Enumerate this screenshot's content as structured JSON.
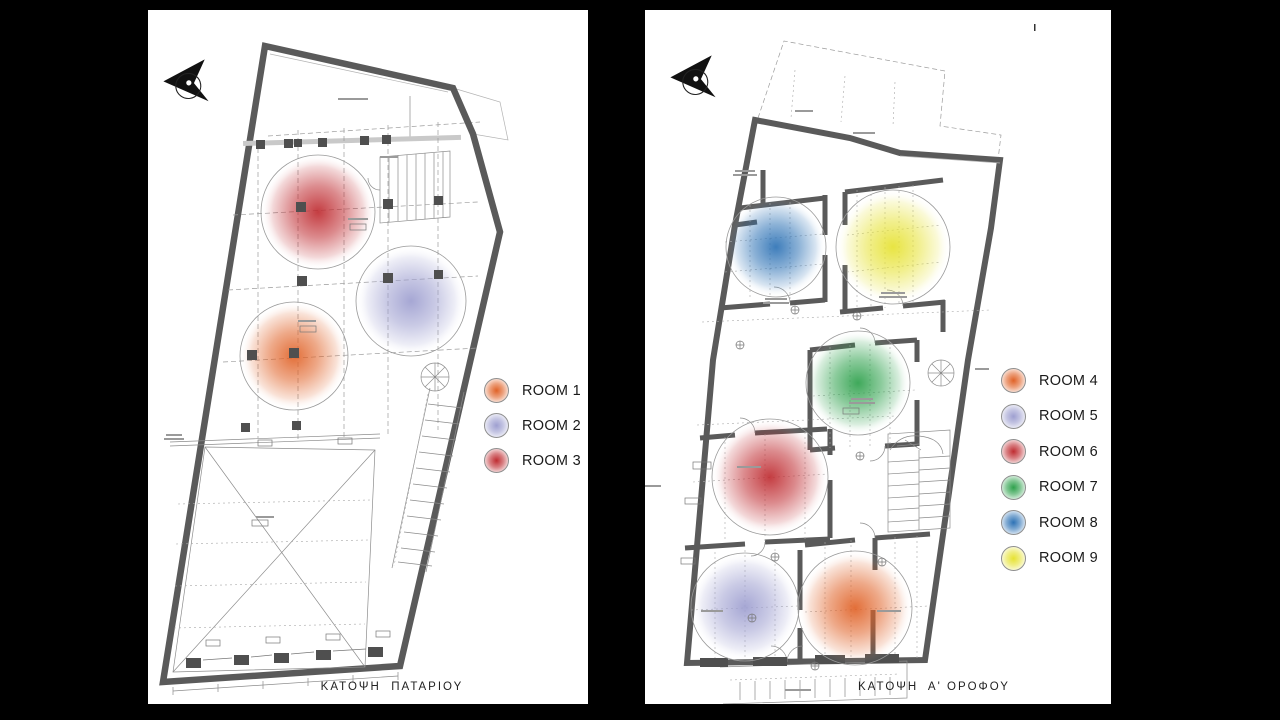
{
  "colors": {
    "background": "#000000",
    "paper": "#ffffff",
    "wall": "#5a5a5a",
    "room1": "#e06227",
    "room2": "#9e9fd0",
    "room3": "#bf2c31",
    "room4": "#e06227",
    "room5": "#9e9fd0",
    "room6": "#bf2c31",
    "room7": "#2ea14c",
    "room8": "#2d72b5",
    "room9": "#e6e232"
  },
  "left_panel": {
    "caption": "ΚΑΤΟΨΗ  ΠΑΤΑΡΙΟΥ",
    "legend": [
      {
        "label": "ROOM 1",
        "color": "#e06227"
      },
      {
        "label": "ROOM 2",
        "color": "#9e9fd0"
      },
      {
        "label": "ROOM 3",
        "color": "#bf2c31"
      }
    ]
  },
  "right_panel": {
    "caption": "ΚΑΤΟΨΗ  Α' ΟΡΟΦΟΥ",
    "legend": [
      {
        "label": "ROOM 4",
        "color": "#e06227"
      },
      {
        "label": "ROOM 5",
        "color": "#9e9fd0"
      },
      {
        "label": "ROOM 6",
        "color": "#bf2c31"
      },
      {
        "label": "ROOM 7",
        "color": "#2ea14c"
      },
      {
        "label": "ROOM 8",
        "color": "#2d72b5"
      },
      {
        "label": "ROOM 9",
        "color": "#e6e232"
      }
    ]
  }
}
